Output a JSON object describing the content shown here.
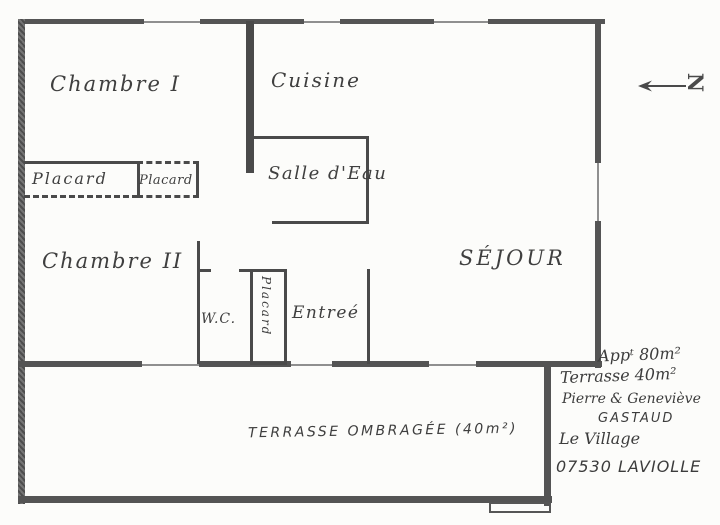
{
  "plan": {
    "rooms": {
      "chambre1": "Chambre I",
      "cuisine": "Cuisine",
      "salle_eau": "Salle d'Eau",
      "placard_left": "Placard",
      "placard_right": "Placard",
      "placard_entry": "Placard",
      "chambre2": "Chambre II",
      "wc": "W.C.",
      "entree": "Entreé",
      "sejour": "SÉJOUR",
      "terrasse": "TERRASSE OMBRAGÉE (40m²)"
    },
    "compass": {
      "letter": "N"
    },
    "notes": {
      "line1": "Appᵗ 80m²",
      "line2": "Terrasse  40m²",
      "line3": "Pierre & Geneviève",
      "line4": "GASTAUD",
      "line5": "Le Village",
      "line6": "07530 LAVIOLLE"
    },
    "colors": {
      "pencil_ink": "#4a4a4a",
      "thin_line": "#8f8f8f",
      "paper": "#fcfcfa"
    }
  }
}
